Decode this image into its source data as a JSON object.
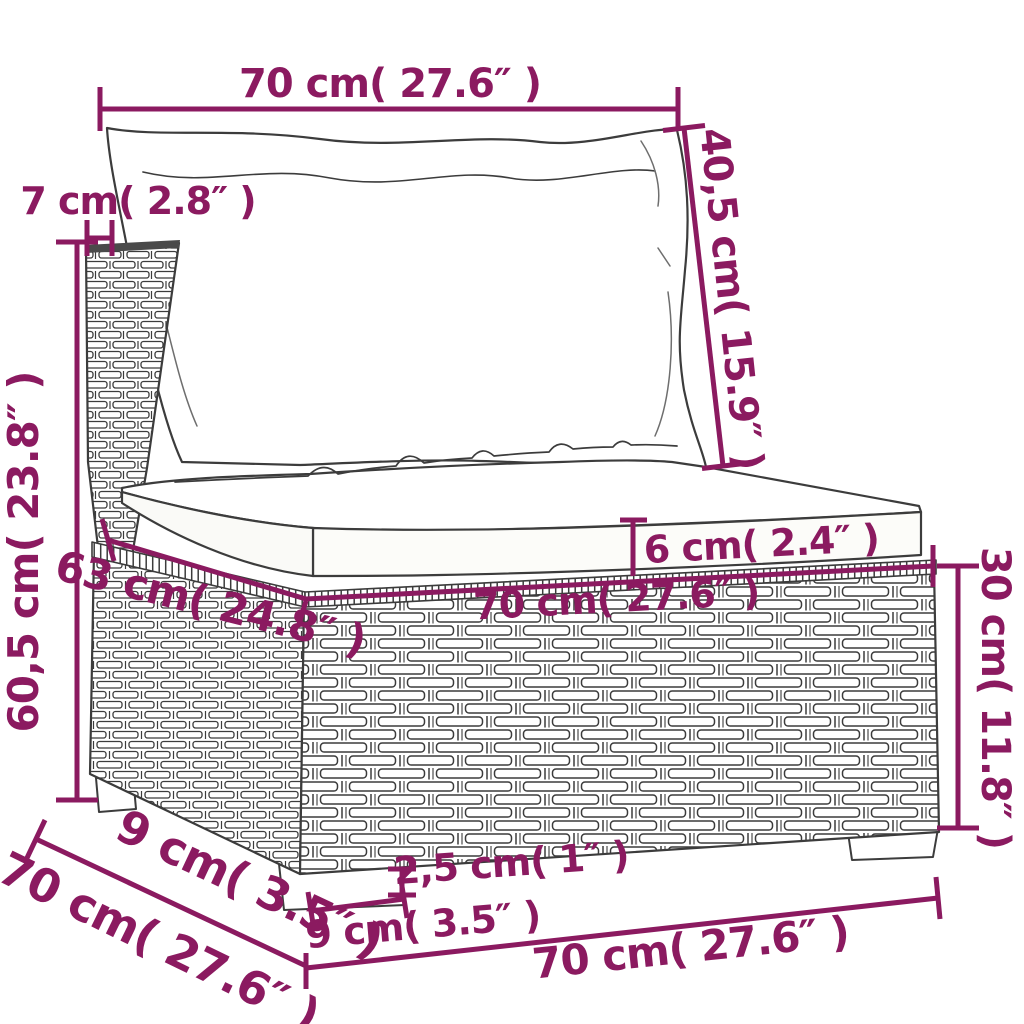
{
  "figure": {
    "type": "product-dimension-diagram",
    "subject": "poly-rattan garden sofa middle section with back pillow and seat cushion",
    "colors": {
      "dimension": "#8B1A60",
      "outline": "#3C3C3C",
      "background": "#FFFFFF"
    },
    "dims": {
      "cushion_width_top": {
        "label": "70 cm( 27.6″ )"
      },
      "back_cushion_height": {
        "label": "40,5 cm( 15.9″ )"
      },
      "back_panel_thickness": {
        "label": "7 cm( 2.8″ )"
      },
      "total_height": {
        "label": "60,5 cm( 23.8″ )"
      },
      "seat_cushion_thickness": {
        "label": "6 cm( 2.4″ )"
      },
      "seat_depth": {
        "label": "63 cm( 24.8″ )"
      },
      "seat_width": {
        "label": "70 cm( 27.6″ )"
      },
      "base_height": {
        "label": "30 cm( 11.8″ )"
      },
      "leg_height": {
        "label": "2,5 cm( 1″ )"
      },
      "leg_width": {
        "label": "9 cm( 3.5″ )"
      },
      "leg_depth": {
        "label": "9 cm( 3.5″ )"
      },
      "base_depth": {
        "label": "70 cm( 27.6″ )"
      },
      "base_width": {
        "label": "70 cm( 27.6″ )"
      }
    }
  }
}
